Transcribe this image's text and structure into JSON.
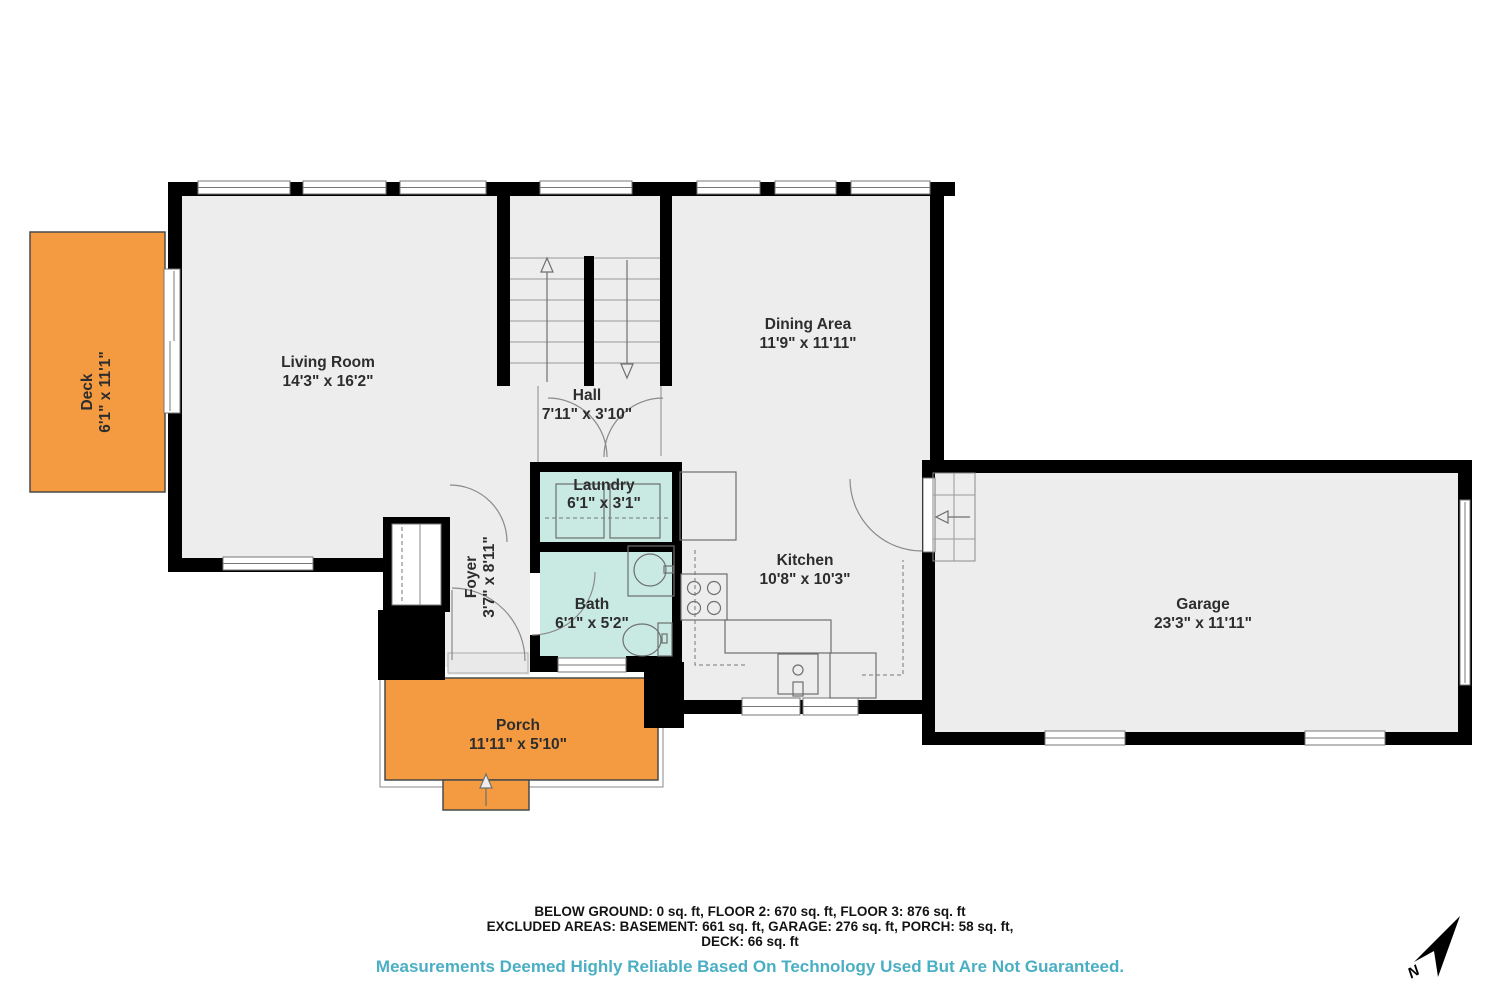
{
  "plan": {
    "title": "Floor plan",
    "rooms": {
      "living": {
        "name": "Living Room",
        "dims": "14'3\" x 16'2\""
      },
      "dining": {
        "name": "Dining Area",
        "dims": "11'9\" x 11'11\""
      },
      "hall": {
        "name": "Hall",
        "dims": "7'11\" x 3'10\""
      },
      "laundry": {
        "name": "Laundry",
        "dims": "6'1\" x 3'1\""
      },
      "bath": {
        "name": "Bath",
        "dims": "6'1\" x 5'2\""
      },
      "foyer": {
        "name": "Foyer",
        "dims": "3'7\" x 8'11\""
      },
      "kitchen": {
        "name": "Kitchen",
        "dims": "10'8\" x 10'3\""
      },
      "garage": {
        "name": "Garage",
        "dims": "23'3\" x 11'11\""
      },
      "deck": {
        "name": "Deck",
        "dims": "6'1\" x 11'1\""
      },
      "porch": {
        "name": "Porch",
        "dims": "11'11\" x 5'10\""
      }
    }
  },
  "footer": {
    "line1": "BELOW GROUND: 0 sq. ft, FLOOR 2: 670 sq. ft, FLOOR 3: 876 sq. ft",
    "line2": "EXCLUDED AREAS: BASEMENT: 661 sq. ft, GARAGE: 276 sq. ft, PORCH: 58 sq. ft,",
    "line3": "DECK: 66 sq. ft",
    "disclaimer": "Measurements Deemed Highly Reliable Based On Technology Used But Are Not Guaranteed."
  },
  "compass": {
    "label": "N"
  },
  "colors": {
    "walls": "#000000",
    "floor": "#ededed",
    "outdoor_orange": "#f49a40",
    "wet_room_teal": "#c9eae2",
    "disclaimer_text": "#4aafc4"
  }
}
